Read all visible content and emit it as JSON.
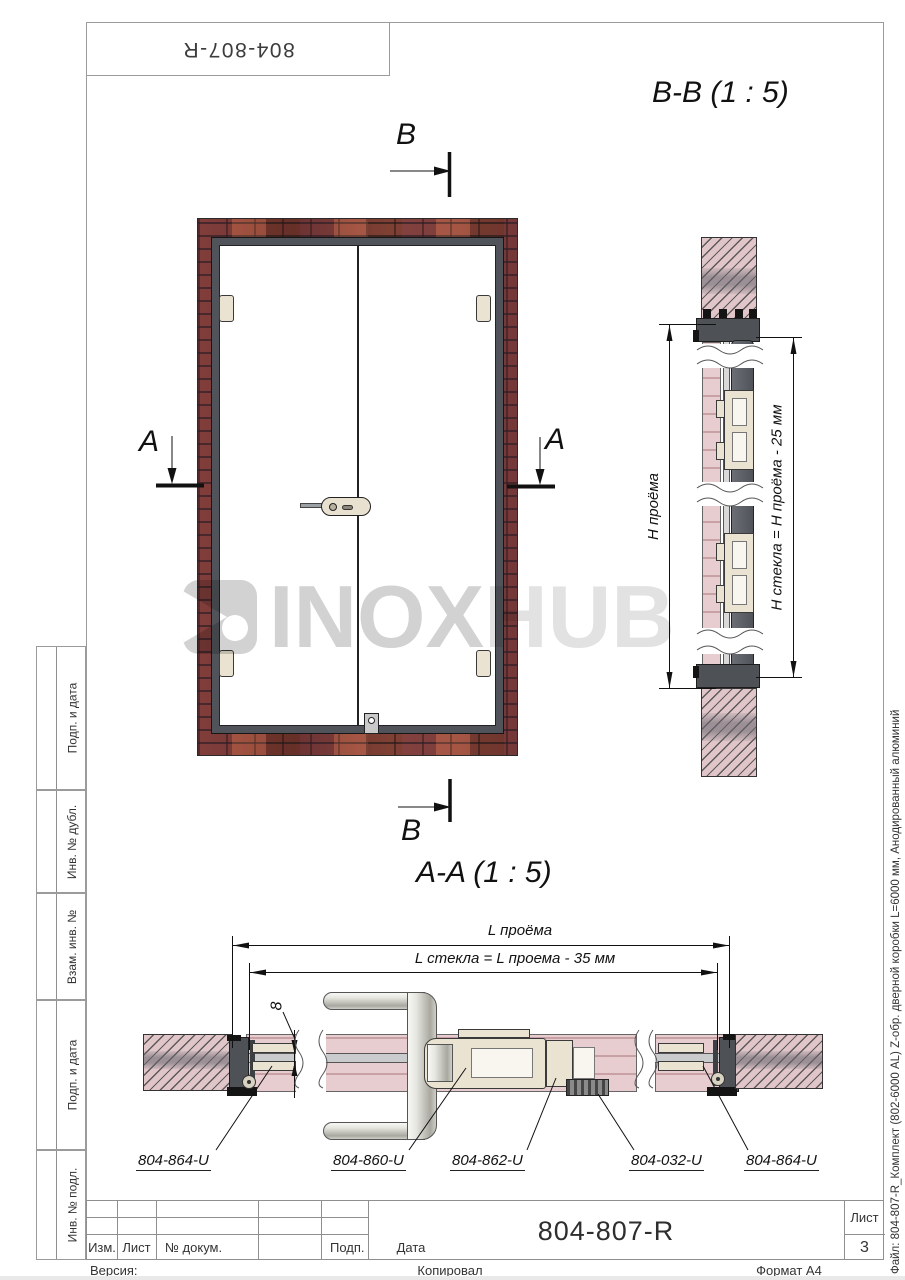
{
  "doc": {
    "number_top": "804-807-R"
  },
  "watermark": {
    "brand_primary": "INOX",
    "brand_secondary": "HUB"
  },
  "front_view": {
    "marker_a": "A",
    "marker_b": "B"
  },
  "section_bb": {
    "title": "B-B (1 : 5)",
    "dim_opening_height": "H проёма",
    "dim_glass_height": "H стекла = H проёма - 25 мм"
  },
  "section_aa": {
    "title": "A-A (1 : 5)",
    "dim_opening_width": "L проёма",
    "dim_glass_width": "L стекла = L проема - 35 мм",
    "dim_glass_thickness": "8",
    "callouts": [
      "804-864-U",
      "804-860-U",
      "804-862-U",
      "804-032-U",
      "804-864-U"
    ]
  },
  "left_margin": {
    "strips": [
      "Подп. и дата",
      "Инв. № дубл.",
      "Взам. инв. №",
      "Подп. и дата",
      "Инв. № подл."
    ]
  },
  "right_margin": {
    "file_label": "Файл: 804-807-R_Комплект (802-6000 AL) Z-обр. дверной коробки L=6000 мм, Анодированный алюминий"
  },
  "title_block": {
    "col_izm": "Изм.",
    "col_list": "Лист",
    "col_doc": "№ докум.",
    "col_podp": "Подп.",
    "col_data": "Дата",
    "doc_number": "804-807-R",
    "sheet_label": "Лист",
    "sheet_number": "3",
    "footer_version": "Версия:",
    "footer_copied": "Копировал",
    "footer_format": "Формат A4"
  },
  "colors": {
    "brick": "#8d3b30",
    "frame_profile": "#4e5257",
    "wall_hatch": "#e0c6c9",
    "hardware": "#ebe3d2",
    "watermark": "#d2d2d2",
    "line": "#111111"
  }
}
